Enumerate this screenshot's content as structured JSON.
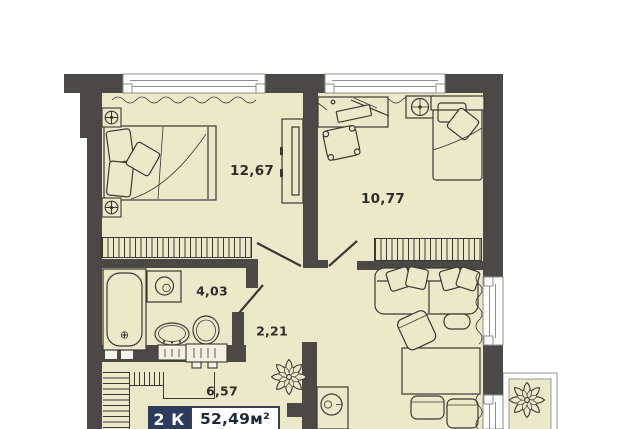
{
  "floor_plan": {
    "badge": {
      "rooms": "2 К",
      "area": "52,49м²"
    },
    "areas": {
      "bedroom_1": "12,67",
      "bedroom_2": "10,77",
      "bathroom": "4,03",
      "corridor": "2,21",
      "hallway": "6,57"
    },
    "colors": {
      "wall": "#4a4947",
      "floor": "#ece9ca",
      "outline": "#3a3933",
      "window_frame": "#8f8f88",
      "badge_bg": "#2d3b5d",
      "badge_text": "#ffffff",
      "label_text": "#2d2d28",
      "background": "#ffffff"
    }
  }
}
